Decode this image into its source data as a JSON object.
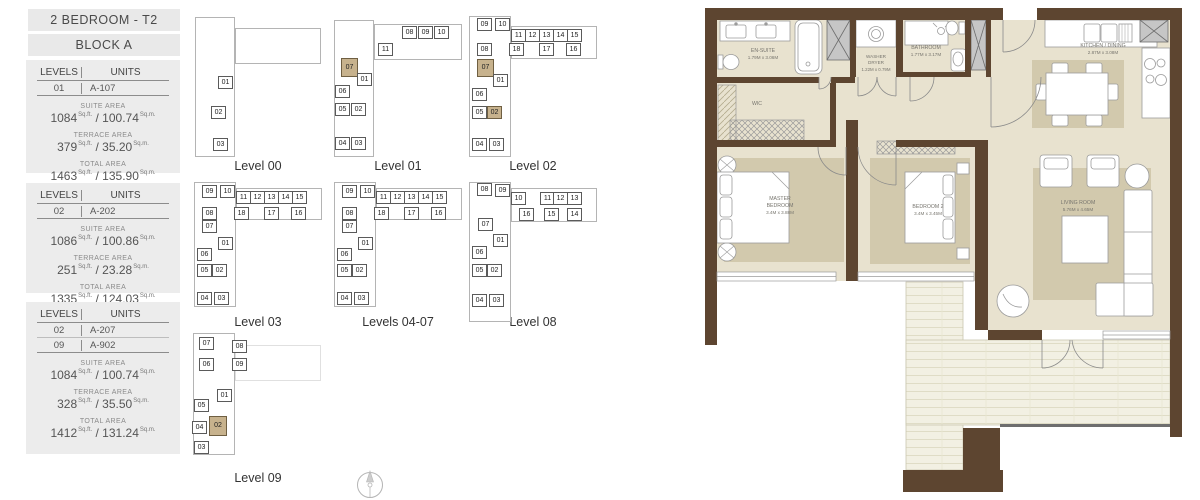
{
  "sidebar": {
    "title": "2 BEDROOM - T2",
    "block": "BLOCK A",
    "labels": {
      "levels": "LEVELS",
      "units": "UNITS",
      "suite": "SUITE AREA",
      "terrace": "TERRACE AREA",
      "total": "TOTAL AREA",
      "sqft": "Sq.ft.",
      "sqm": "Sq.m."
    },
    "cards": [
      {
        "rows": [
          {
            "level": "01",
            "unit": "A-107"
          }
        ],
        "suite": {
          "sqft": "1084",
          "sqm": "100.74"
        },
        "terrace": {
          "sqft": "379",
          "sqm": "35.20"
        },
        "total": {
          "sqft": "1463",
          "sqm": "135.90"
        }
      },
      {
        "rows": [
          {
            "level": "02",
            "unit": "A-202"
          }
        ],
        "suite": {
          "sqft": "1086",
          "sqm": "100.86"
        },
        "terrace": {
          "sqft": "251",
          "sqm": "23.28"
        },
        "total": {
          "sqft": "1335",
          "sqm": "124.03"
        }
      },
      {
        "rows": [
          {
            "level": "02",
            "unit": "A-207"
          },
          {
            "level": "09",
            "unit": "A-902"
          }
        ],
        "suite": {
          "sqft": "1084",
          "sqm": "100.74"
        },
        "terrace": {
          "sqft": "328",
          "sqm": "35.50"
        },
        "total": {
          "sqft": "1412",
          "sqm": "131.24"
        }
      }
    ]
  },
  "key_plans": [
    {
      "caption": "Level 00",
      "x": 190,
      "y": 10,
      "ch": 146,
      "wings": [
        {
          "x": 5,
          "y": 7,
          "w": 40,
          "h": 140
        },
        {
          "x": 45,
          "y": 18,
          "w": 86,
          "h": 36
        }
      ],
      "cells": [
        {
          "n": "01",
          "x": 28,
          "y": 66
        },
        {
          "n": "02",
          "x": 21,
          "y": 96
        },
        {
          "n": "03",
          "x": 23,
          "y": 128
        }
      ]
    },
    {
      "caption": "Level 01",
      "x": 330,
      "y": 10,
      "ch": 146,
      "wings": [
        {
          "x": 4,
          "y": 10,
          "w": 40,
          "h": 137
        },
        {
          "x": 44,
          "y": 14,
          "w": 88,
          "h": 36
        }
      ],
      "cells": [
        {
          "n": "08",
          "x": 72,
          "y": 16
        },
        {
          "n": "09",
          "x": 88,
          "y": 16
        },
        {
          "n": "10",
          "x": 104,
          "y": 16
        },
        {
          "n": "11",
          "x": 48,
          "y": 33
        },
        {
          "n": "07",
          "x": 11,
          "y": 48,
          "w": 17,
          "h": 19,
          "hl": true
        },
        {
          "n": "01",
          "x": 27,
          "y": 63
        },
        {
          "n": "06",
          "x": 5,
          "y": 75
        },
        {
          "n": "05",
          "x": 5,
          "y": 93
        },
        {
          "n": "02",
          "x": 21,
          "y": 93
        },
        {
          "n": "04",
          "x": 5,
          "y": 127
        },
        {
          "n": "03",
          "x": 21,
          "y": 127
        }
      ]
    },
    {
      "caption": "Level 02",
      "x": 465,
      "y": 10,
      "ch": 146,
      "wings": [
        {
          "x": 4,
          "y": 6,
          "w": 42,
          "h": 141
        },
        {
          "x": 46,
          "y": 16,
          "w": 86,
          "h": 33
        }
      ],
      "cells": [
        {
          "n": "09",
          "x": 12,
          "y": 8
        },
        {
          "n": "10",
          "x": 30,
          "y": 8
        },
        {
          "n": "11",
          "x": 46,
          "y": 19
        },
        {
          "n": "12",
          "x": 60,
          "y": 19
        },
        {
          "n": "13",
          "x": 74,
          "y": 19
        },
        {
          "n": "14",
          "x": 88,
          "y": 19
        },
        {
          "n": "15",
          "x": 102,
          "y": 19
        },
        {
          "n": "08",
          "x": 12,
          "y": 33
        },
        {
          "n": "18",
          "x": 44,
          "y": 33
        },
        {
          "n": "17",
          "x": 74,
          "y": 33
        },
        {
          "n": "16",
          "x": 101,
          "y": 33
        },
        {
          "n": "07",
          "x": 12,
          "y": 49,
          "w": 17,
          "h": 18,
          "hl": true
        },
        {
          "n": "01",
          "x": 28,
          "y": 64
        },
        {
          "n": "06",
          "x": 7,
          "y": 78
        },
        {
          "n": "05",
          "x": 7,
          "y": 96
        },
        {
          "n": "02",
          "x": 22,
          "y": 96,
          "hl": true
        },
        {
          "n": "04",
          "x": 7,
          "y": 128
        },
        {
          "n": "03",
          "x": 24,
          "y": 128
        }
      ]
    },
    {
      "caption": "Level 03",
      "x": 190,
      "y": 180,
      "ch": 132,
      "wings": [
        {
          "x": 4,
          "y": 2,
          "w": 42,
          "h": 125
        },
        {
          "x": 46,
          "y": 8,
          "w": 86,
          "h": 32
        }
      ],
      "cells": [
        {
          "n": "09",
          "x": 12,
          "y": 5
        },
        {
          "n": "10",
          "x": 30,
          "y": 5
        },
        {
          "n": "11",
          "x": 46,
          "y": 11
        },
        {
          "n": "12",
          "x": 60,
          "y": 11
        },
        {
          "n": "13",
          "x": 74,
          "y": 11
        },
        {
          "n": "14",
          "x": 88,
          "y": 11
        },
        {
          "n": "15",
          "x": 102,
          "y": 11
        },
        {
          "n": "08",
          "x": 12,
          "y": 27
        },
        {
          "n": "18",
          "x": 44,
          "y": 27
        },
        {
          "n": "17",
          "x": 74,
          "y": 27
        },
        {
          "n": "16",
          "x": 101,
          "y": 27
        },
        {
          "n": "07",
          "x": 12,
          "y": 40
        },
        {
          "n": "01",
          "x": 28,
          "y": 57
        },
        {
          "n": "06",
          "x": 7,
          "y": 68
        },
        {
          "n": "05",
          "x": 7,
          "y": 84
        },
        {
          "n": "02",
          "x": 22,
          "y": 84
        },
        {
          "n": "04",
          "x": 7,
          "y": 112
        },
        {
          "n": "03",
          "x": 24,
          "y": 112
        }
      ]
    },
    {
      "caption": "Levels 04-07",
      "x": 330,
      "y": 180,
      "ch": 132,
      "wings": [
        {
          "x": 4,
          "y": 2,
          "w": 42,
          "h": 125
        },
        {
          "x": 46,
          "y": 8,
          "w": 86,
          "h": 32
        }
      ],
      "cells": [
        {
          "n": "09",
          "x": 12,
          "y": 5
        },
        {
          "n": "10",
          "x": 30,
          "y": 5
        },
        {
          "n": "11",
          "x": 46,
          "y": 11
        },
        {
          "n": "12",
          "x": 60,
          "y": 11
        },
        {
          "n": "13",
          "x": 74,
          "y": 11
        },
        {
          "n": "14",
          "x": 88,
          "y": 11
        },
        {
          "n": "15",
          "x": 102,
          "y": 11
        },
        {
          "n": "08",
          "x": 12,
          "y": 27
        },
        {
          "n": "18",
          "x": 44,
          "y": 27
        },
        {
          "n": "17",
          "x": 74,
          "y": 27
        },
        {
          "n": "16",
          "x": 101,
          "y": 27
        },
        {
          "n": "07",
          "x": 12,
          "y": 40
        },
        {
          "n": "01",
          "x": 28,
          "y": 57
        },
        {
          "n": "06",
          "x": 7,
          "y": 68
        },
        {
          "n": "05",
          "x": 7,
          "y": 84
        },
        {
          "n": "02",
          "x": 22,
          "y": 84
        },
        {
          "n": "04",
          "x": 7,
          "y": 112
        },
        {
          "n": "03",
          "x": 24,
          "y": 112
        }
      ]
    },
    {
      "caption": "Level 08",
      "x": 465,
      "y": 180,
      "ch": 132,
      "wings": [
        {
          "x": 4,
          "y": 2,
          "w": 42,
          "h": 140
        },
        {
          "x": 46,
          "y": 8,
          "w": 86,
          "h": 34
        }
      ],
      "cells": [
        {
          "n": "08",
          "x": 12,
          "y": 3
        },
        {
          "n": "09",
          "x": 30,
          "y": 4
        },
        {
          "n": "10",
          "x": 46,
          "y": 12
        },
        {
          "n": "11",
          "x": 75,
          "y": 12
        },
        {
          "n": "12",
          "x": 88,
          "y": 12
        },
        {
          "n": "13",
          "x": 102,
          "y": 12
        },
        {
          "n": "16",
          "x": 54,
          "y": 28
        },
        {
          "n": "15",
          "x": 79,
          "y": 28
        },
        {
          "n": "14",
          "x": 102,
          "y": 28
        },
        {
          "n": "07",
          "x": 13,
          "y": 38
        },
        {
          "n": "01",
          "x": 28,
          "y": 54
        },
        {
          "n": "06",
          "x": 7,
          "y": 66
        },
        {
          "n": "05",
          "x": 7,
          "y": 84
        },
        {
          "n": "02",
          "x": 22,
          "y": 84
        },
        {
          "n": "04",
          "x": 7,
          "y": 114
        },
        {
          "n": "03",
          "x": 24,
          "y": 114
        }
      ]
    },
    {
      "caption": "Level 09",
      "x": 190,
      "y": 330,
      "ch": 138,
      "wings": [
        {
          "x": 3,
          "y": 3,
          "w": 42,
          "h": 122
        },
        {
          "x": 45,
          "y": 15,
          "w": 86,
          "h": 36,
          "ghost": true
        }
      ],
      "cells": [
        {
          "n": "07",
          "x": 9,
          "y": 7
        },
        {
          "n": "08",
          "x": 42,
          "y": 10
        },
        {
          "n": "06",
          "x": 9,
          "y": 28
        },
        {
          "n": "09",
          "x": 42,
          "y": 28
        },
        {
          "n": "01",
          "x": 27,
          "y": 59
        },
        {
          "n": "05",
          "x": 4,
          "y": 69
        },
        {
          "n": "02",
          "x": 19,
          "y": 86,
          "w": 18,
          "h": 20,
          "hl": true
        },
        {
          "n": "04",
          "x": 2,
          "y": 91
        },
        {
          "n": "03",
          "x": 4,
          "y": 111
        }
      ]
    }
  ],
  "floor_plan": {
    "rooms": {
      "ensuite": {
        "name": "EN-SUITE",
        "dims": "1.79M x 3.06M"
      },
      "wic": {
        "name": "WIC"
      },
      "washer": {
        "line1": "WASHER",
        "line2": "DRYER",
        "dims": "1.22M x 0.79M"
      },
      "bathroom": {
        "name": "BATHROOM",
        "dims": "1.77M x 3.17M"
      },
      "kitchen": {
        "name": "KITCHEN / DINING",
        "dims": "2.87M x 3.08M"
      },
      "master": {
        "line1": "MASTER",
        "line2": "BEDROOM",
        "dims": "3.4M x 3.88M"
      },
      "bedroom2": {
        "name": "BEDROOM 2",
        "dims": "3.4M x 3.45M"
      },
      "living": {
        "name": "LIVING ROOM",
        "dims": "5.76M x 4.65M"
      }
    },
    "colors": {
      "wall": "#5d4530",
      "floor": "#e8e2cf",
      "rug": "#d2c9ad",
      "deck": "#f2f0e3",
      "highlight": "#c7b28d"
    }
  }
}
